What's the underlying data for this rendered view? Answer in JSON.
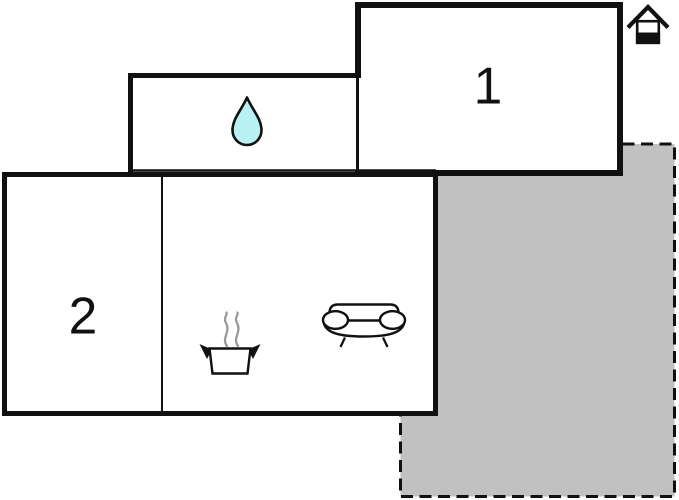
{
  "floorplan": {
    "type": "floor-plan",
    "rooms": [
      {
        "name": "room-1",
        "label": "1"
      },
      {
        "name": "room-2",
        "label": "2"
      },
      {
        "name": "bathroom",
        "icon": "water-drop-icon"
      },
      {
        "name": "kitchen",
        "icon": "cooking-pot-steam-icon"
      },
      {
        "name": "living-area",
        "icon": "sofa-icon"
      },
      {
        "name": "terrace",
        "appearance": "gray-fill-dashed-outline"
      }
    ],
    "entrance_marker": {
      "icon": "house-entrance-icon",
      "position": "top-right"
    }
  },
  "colors": {
    "wall": "#111111",
    "room_fill": "#ffffff",
    "terrace_fill": "#c1c1c1",
    "terrace_border": "#111111",
    "water_drop_fill": "#b9f0f1",
    "steam": "#999999",
    "label": "#111111"
  }
}
